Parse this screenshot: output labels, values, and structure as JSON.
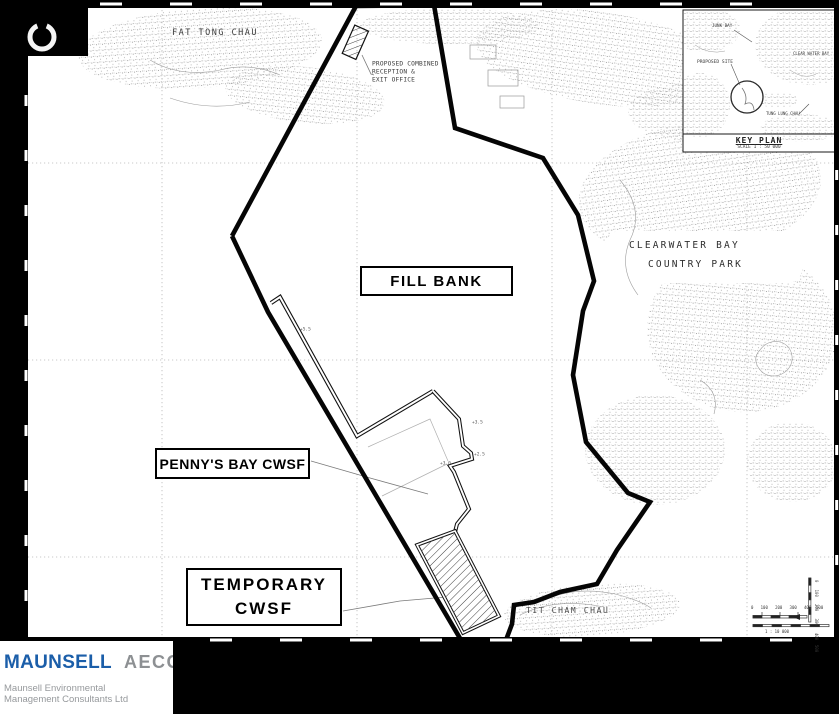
{
  "map": {
    "place_labels": {
      "fat_tong_chau": "FAT TONG CHAU",
      "clearwater_bay": "CLEARWATER BAY",
      "country_park": "COUNTRY PARK",
      "tit_cham_chau": "TIT CHAM CHAU"
    },
    "feature_labels": {
      "fill_bank": "FILL BANK",
      "pennys_bay_cwsf": "PENNY'S BAY CWSF",
      "temporary_line1": "TEMPORARY",
      "temporary_line2": "CWSF",
      "reception_line1": "PROPOSED COMBINED",
      "reception_line2": "RECEPTION &",
      "reception_line3": "EXIT OFFICE"
    },
    "spot_levels": [
      "+5.5",
      "+3.5",
      "+2.5",
      "+3.0"
    ],
    "key_plan": {
      "title": "KEY PLAN",
      "scale": "SCALE 1 : 50 000",
      "junk_bay": "JUNK BAY",
      "proposed_site": "PROPOSED SITE",
      "clear_water_bay": "CLEAR WATER BAY",
      "tung_lung_chau": "TUNG LUNG CHAU"
    },
    "scale_bar": {
      "numbers": "0   100   200   300   400  500",
      "caption": "1 : 10 000"
    }
  },
  "footer": {
    "brand_primary": "MAUNSELL",
    "brand_secondary": "AECOM",
    "subtitle_line1": "Maunsell Environmental",
    "subtitle_line2": "Management Consultants Ltd"
  },
  "colors": {
    "brand_blue": "#1b5ea9",
    "brand_gray": "#8d9093",
    "page_bg": "#ffffff",
    "canvas_bg": "#000000",
    "linework": "#0a0a0a"
  }
}
